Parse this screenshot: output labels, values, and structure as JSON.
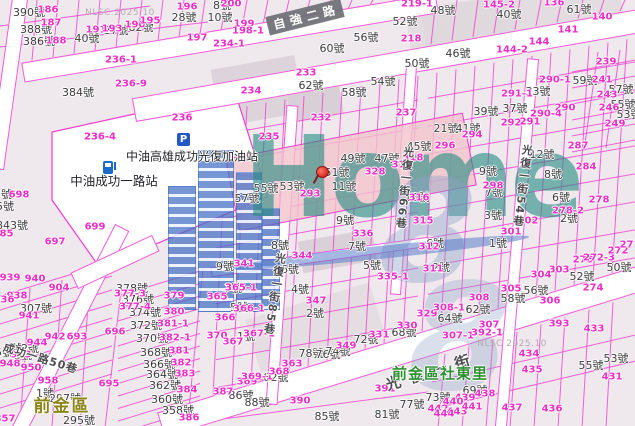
{
  "map": {
    "attribution": "NLSC 2025.10",
    "watermark": {
      "brand": "Home",
      "digit": "8"
    },
    "poi": {
      "parking_icon": "P",
      "gas_station_name": "中油高雄成功光復加油站",
      "cpc_station_name": "中油成功一路站"
    },
    "areas": {
      "district": "前金區",
      "village": "前金區社東里"
    },
    "roads": {
      "ziqiang_2nd_rd": "自強二路",
      "guangfu_1st_st": "光復一街",
      "lane_85": "光復一街85巷",
      "lane_66": "光復一街66巷",
      "lane_54": "光復一街54巷",
      "lane_50": "成功一路50巷"
    },
    "colors": {
      "parcel_line": "#f43bd0",
      "lot_number_text": "#f02cc8",
      "house_number_text": "#3b3b3b",
      "highlight_parcel": "#f3c3cc",
      "watermark_teal": "#288c82",
      "watermark_blue": "#426ec3",
      "district_text": "#8b8516",
      "village_text": "#2f9033"
    },
    "labels": {
      "house_numbers": [
        [
          29,
          12,
          "390號"
        ],
        [
          36,
          29,
          "388號"
        ],
        [
          39,
          41,
          "386號"
        ],
        [
          87,
          38,
          "40號"
        ],
        [
          116,
          30,
          "27號"
        ],
        [
          141,
          27,
          "82號"
        ],
        [
          184,
          17,
          "28號"
        ],
        [
          78,
          92,
          "384號"
        ],
        [
          222,
          5,
          "8號"
        ],
        [
          220,
          17,
          "10號"
        ],
        [
          311,
          85,
          "62號"
        ],
        [
          332,
          48,
          "60號"
        ],
        [
          366,
          37,
          "56號"
        ],
        [
          354,
          92,
          "58號"
        ],
        [
          383,
          81,
          "54號"
        ],
        [
          405,
          21,
          "52號"
        ],
        [
          417,
          63,
          "50號"
        ],
        [
          443,
          10,
          "48號"
        ],
        [
          509,
          14,
          "40號"
        ],
        [
          579,
          9,
          "61號"
        ],
        [
          458,
          53,
          "46號"
        ],
        [
          585,
          80,
          "59號"
        ],
        [
          621,
          89,
          "57號"
        ],
        [
          623,
          104,
          "55號"
        ],
        [
          629,
          114,
          "53號"
        ],
        [
          538,
          91,
          "33號"
        ],
        [
          486,
          111,
          "39號"
        ],
        [
          515,
          108,
          "37號"
        ],
        [
          446,
          128,
          "21號"
        ],
        [
          468,
          128,
          "41號"
        ],
        [
          419,
          146,
          "45號"
        ],
        [
          353,
          158,
          "49號"
        ],
        [
          387,
          158,
          "47號"
        ],
        [
          337,
          172,
          "51號"
        ],
        [
          266,
          188,
          "55號"
        ],
        [
          292,
          186,
          "53號"
        ],
        [
          344,
          186,
          "11號"
        ],
        [
          247,
          198,
          "57號"
        ],
        [
          417,
          197,
          "10號"
        ],
        [
          345,
          220,
          "9號"
        ],
        [
          280,
          245,
          "8號"
        ],
        [
          357,
          246,
          "7號"
        ],
        [
          225,
          266,
          "9號"
        ],
        [
          290,
          269,
          "6號"
        ],
        [
          372,
          265,
          "5號"
        ],
        [
          488,
          171,
          "9號"
        ],
        [
          542,
          154,
          "12號"
        ],
        [
          553,
          174,
          "8號"
        ],
        [
          494,
          192,
          "7號"
        ],
        [
          561,
          197,
          "6號"
        ],
        [
          493,
          215,
          "3號"
        ],
        [
          569,
          218,
          "2號"
        ],
        [
          498,
          243,
          "1號"
        ],
        [
          435,
          243,
          "6號"
        ],
        [
          441,
          267,
          "2號"
        ],
        [
          582,
          276,
          "52號"
        ],
        [
          619,
          267,
          "50號"
        ],
        [
          12,
          225,
          "843號"
        ],
        [
          5,
          206,
          "5號"
        ],
        [
          3,
          194,
          "3號"
        ],
        [
          36,
          308,
          "307號"
        ],
        [
          132,
          288,
          "378號"
        ],
        [
          138,
          299,
          "376號"
        ],
        [
          145,
          312,
          "374號"
        ],
        [
          146,
          325,
          "372號"
        ],
        [
          152,
          338,
          "370號"
        ],
        [
          156,
          352,
          "368號"
        ],
        [
          159,
          364,
          "366號"
        ],
        [
          162,
          374,
          "364號"
        ],
        [
          165,
          385,
          "362號"
        ],
        [
          167,
          399,
          "360號"
        ],
        [
          178,
          410,
          "358號"
        ],
        [
          45,
          393,
          "1號"
        ],
        [
          65,
          398,
          "297號"
        ],
        [
          79,
          420,
          "295號"
        ],
        [
          13,
          348,
          "4號"
        ],
        [
          30,
          348,
          "2號"
        ],
        [
          4,
          352,
          "5號"
        ],
        [
          23,
          355,
          "3號"
        ],
        [
          233,
          288,
          "7號"
        ],
        [
          239,
          307,
          "5號"
        ],
        [
          246,
          336,
          "1號"
        ],
        [
          300,
          289,
          "4號"
        ],
        [
          315,
          313,
          "2號"
        ],
        [
          311,
          353,
          "78號"
        ],
        [
          328,
          354,
          "76號"
        ],
        [
          338,
          351,
          "74號"
        ],
        [
          366,
          339,
          "72號"
        ],
        [
          404,
          332,
          "68號"
        ],
        [
          241,
          395,
          "86號"
        ],
        [
          257,
          402,
          "88號"
        ],
        [
          276,
          377,
          "82號"
        ],
        [
          536,
          290,
          "56號"
        ],
        [
          513,
          298,
          "58號"
        ],
        [
          478,
          309,
          "62號"
        ],
        [
          450,
          318,
          "64號"
        ],
        [
          591,
          365,
          "55號"
        ],
        [
          616,
          358,
          "53號"
        ],
        [
          475,
          390,
          "69號"
        ],
        [
          438,
          397,
          "73號"
        ],
        [
          327,
          416,
          "85號"
        ],
        [
          387,
          414,
          "81號"
        ],
        [
          412,
          404,
          "77號"
        ]
      ],
      "lot_numbers": [
        [
          48,
          10,
          "186"
        ],
        [
          51,
          23,
          "187"
        ],
        [
          56,
          41,
          "188"
        ],
        [
          96,
          30,
          "191"
        ],
        [
          112,
          29,
          "193"
        ],
        [
          135,
          25,
          "190"
        ],
        [
          150,
          21,
          "195"
        ],
        [
          187,
          7,
          "196"
        ],
        [
          197,
          38,
          "197"
        ],
        [
          121,
          60,
          "236-1"
        ],
        [
          131,
          84,
          "236-9"
        ],
        [
          182,
          118,
          "236"
        ],
        [
          100,
          137,
          "236-4"
        ],
        [
          231,
          4,
          "200"
        ],
        [
          244,
          24,
          "199"
        ],
        [
          248,
          31,
          "198-1"
        ],
        [
          229,
          44,
          "234-1"
        ],
        [
          251,
          91,
          "234"
        ],
        [
          306,
          73,
          "233"
        ],
        [
          321,
          118,
          "232"
        ],
        [
          269,
          137,
          "235"
        ],
        [
          411,
          39,
          "218"
        ],
        [
          406,
          113,
          "237"
        ],
        [
          417,
          4,
          "219-1"
        ],
        [
          499,
          5,
          "145-2"
        ],
        [
          554,
          3,
          "136"
        ],
        [
          602,
          17,
          "140"
        ],
        [
          568,
          30,
          "141"
        ],
        [
          539,
          42,
          "144"
        ],
        [
          512,
          50,
          "144-2"
        ],
        [
          606,
          62,
          "239"
        ],
        [
          602,
          80,
          "241"
        ],
        [
          607,
          95,
          "243"
        ],
        [
          609,
          108,
          "246"
        ],
        [
          615,
          124,
          "249"
        ],
        [
          555,
          80,
          "290-1"
        ],
        [
          517,
          94,
          "291-1"
        ],
        [
          565,
          108,
          "290"
        ],
        [
          546,
          114,
          "290-4"
        ],
        [
          511,
          123,
          "292"
        ],
        [
          530,
          122,
          "291"
        ],
        [
          472,
          135,
          "294"
        ],
        [
          445,
          146,
          "296"
        ],
        [
          578,
          146,
          "287"
        ],
        [
          586,
          167,
          "284"
        ],
        [
          493,
          186,
          "298"
        ],
        [
          599,
          200,
          "278"
        ],
        [
          568,
          211,
          "278-2"
        ],
        [
          511,
          232,
          "301"
        ],
        [
          583,
          260,
          "275"
        ],
        [
          599,
          258,
          "272-3"
        ],
        [
          618,
          251,
          "272"
        ],
        [
          630,
          245,
          "271"
        ],
        [
          559,
          270,
          "303"
        ],
        [
          541,
          275,
          "304"
        ],
        [
          528,
          221,
          "302"
        ],
        [
          413,
          158,
          "318"
        ],
        [
          402,
          165,
          "319"
        ],
        [
          375,
          172,
          "328"
        ],
        [
          310,
          194,
          "293"
        ],
        [
          363,
          234,
          "336"
        ],
        [
          302,
          256,
          "344"
        ],
        [
          244,
          264,
          "341"
        ],
        [
          419,
          198,
          "316"
        ],
        [
          423,
          221,
          "315"
        ],
        [
          429,
          247,
          "312"
        ],
        [
          433,
          269,
          "311"
        ],
        [
          393,
          277,
          "335-1"
        ],
        [
          427,
          314,
          "329"
        ],
        [
          19,
          195,
          "698"
        ],
        [
          95,
          227,
          "699"
        ],
        [
          55,
          242,
          "697"
        ],
        [
          10,
          278,
          "939"
        ],
        [
          35,
          279,
          "940"
        ],
        [
          3,
          234,
          "885"
        ],
        [
          115,
          332,
          "696"
        ],
        [
          77,
          337,
          "693"
        ],
        [
          109,
          384,
          "695"
        ],
        [
          59,
          288,
          "904"
        ],
        [
          17,
          296,
          "938"
        ],
        [
          4,
          300,
          "936"
        ],
        [
          29,
          316,
          "941"
        ],
        [
          55,
          337,
          "942"
        ],
        [
          37,
          343,
          "944"
        ],
        [
          21,
          355,
          "943"
        ],
        [
          10,
          364,
          "948"
        ],
        [
          31,
          368,
          "950"
        ],
        [
          48,
          381,
          "958"
        ],
        [
          5,
          419,
          "357"
        ],
        [
          174,
          296,
          "379"
        ],
        [
          174,
          312,
          "380"
        ],
        [
          173,
          324,
          "381-1"
        ],
        [
          175,
          338,
          "382-1"
        ],
        [
          179,
          351,
          "381"
        ],
        [
          181,
          363,
          "382"
        ],
        [
          185,
          374,
          "383"
        ],
        [
          187,
          390,
          "384"
        ],
        [
          189,
          418,
          "386"
        ],
        [
          130,
          294,
          "377-3"
        ],
        [
          135,
          307,
          "377-4"
        ],
        [
          217,
          297,
          "365"
        ],
        [
          241,
          288,
          "365-1"
        ],
        [
          225,
          318,
          "366"
        ],
        [
          249,
          309,
          "366-1"
        ],
        [
          217,
          336,
          "370"
        ],
        [
          233,
          342,
          "367"
        ],
        [
          259,
          334,
          "367-1"
        ],
        [
          247,
          382,
          "369"
        ],
        [
          257,
          377,
          "369-1"
        ],
        [
          223,
          392,
          "387"
        ],
        [
          316,
          301,
          "347"
        ],
        [
          346,
          346,
          "349"
        ],
        [
          407,
          326,
          "330"
        ],
        [
          379,
          335,
          "331"
        ],
        [
          292,
          364,
          "363"
        ],
        [
          279,
          372,
          "368"
        ],
        [
          300,
          401,
          "390"
        ],
        [
          385,
          389,
          "391"
        ],
        [
          479,
          298,
          "308"
        ],
        [
          511,
          289,
          "305"
        ],
        [
          593,
          288,
          "274"
        ],
        [
          550,
          301,
          "306"
        ],
        [
          449,
          308,
          "308-1"
        ],
        [
          489,
          325,
          "307"
        ],
        [
          458,
          336,
          "307-1"
        ],
        [
          487,
          333,
          "392-1"
        ],
        [
          559,
          324,
          "393"
        ],
        [
          594,
          329,
          "433"
        ],
        [
          529,
          354,
          "434"
        ],
        [
          532,
          370,
          "435"
        ],
        [
          552,
          409,
          "436"
        ],
        [
          512,
          408,
          "437"
        ],
        [
          612,
          377,
          "431"
        ],
        [
          465,
          398,
          "439"
        ],
        [
          453,
          402,
          "440"
        ],
        [
          485,
          394,
          "438"
        ],
        [
          438,
          409,
          "442"
        ],
        [
          457,
          412,
          "443"
        ],
        [
          444,
          414,
          "444"
        ],
        [
          472,
          407,
          "441"
        ]
      ]
    }
  }
}
